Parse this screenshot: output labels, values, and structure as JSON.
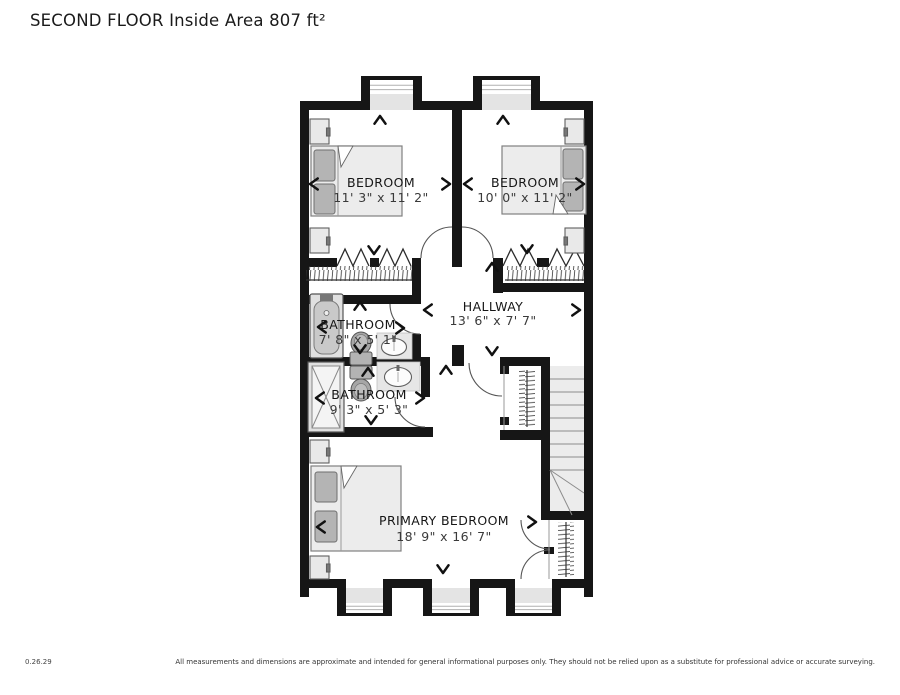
{
  "title": "SECOND FLOOR Inside Area 807 ft²",
  "rooms": {
    "bedroom_left": {
      "name": "BEDROOM",
      "dims": "11' 3\" x 11' 2\""
    },
    "bedroom_right": {
      "name": "BEDROOM",
      "dims": "10' 0\" x 11' 2\""
    },
    "bathroom_upper": {
      "name": "BATHROOM",
      "dims": "7' 8\" x 5' 1\""
    },
    "bathroom_lower": {
      "name": "BATHROOM",
      "dims": "9' 3\" x 5' 3\""
    },
    "hallway": {
      "name": "HALLWAY",
      "dims": "13' 6\" x 7' 7\""
    },
    "primary_bedroom": {
      "name": "PRIMARY BEDROOM",
      "dims": "18' 9\" x 16' 7\""
    }
  },
  "footer": {
    "version": "0.26.29",
    "disclaimer": "All measurements and dimensions are approximate and intended for general informational purposes only. They should not be relied upon as a substitute for professional advice or accurate surveying."
  },
  "colors": {
    "wall": "#161616",
    "floor": "#ffffff",
    "alcove": "#e4e4e4",
    "furniture_fill": "#ececec",
    "pillow": "#b4b4b4",
    "label": "#161616"
  }
}
